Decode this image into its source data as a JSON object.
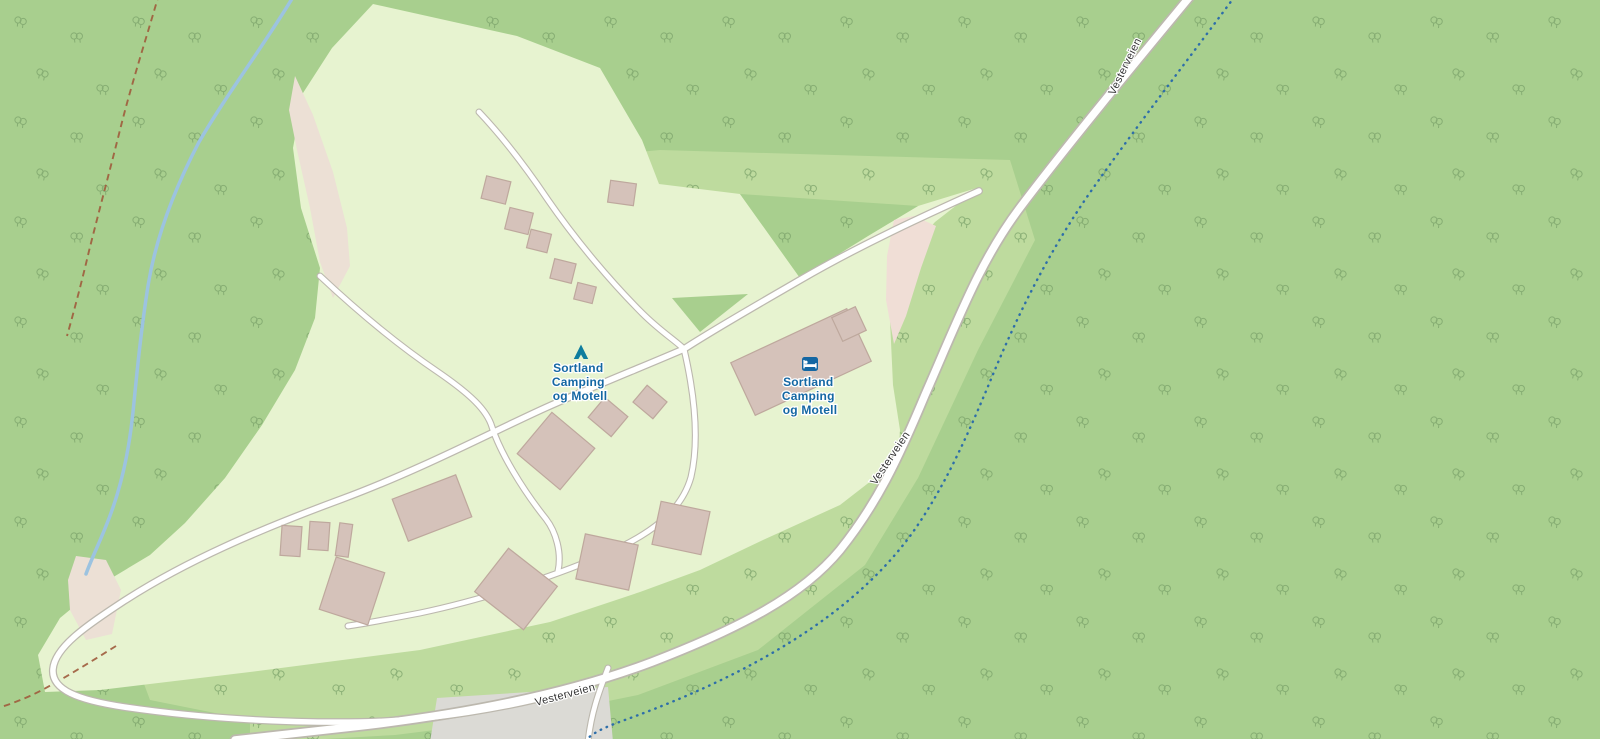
{
  "map": {
    "kind": "openstreetmap-style slippy map tile view",
    "pois": [
      {
        "id": "campsite",
        "icon": "tent-icon",
        "label_lines": [
          "Sortland",
          "Camping",
          "og Motell"
        ]
      },
      {
        "id": "motel",
        "icon": "motel-icon",
        "label_lines": [
          "Sortland",
          "Camping",
          "og Motell"
        ]
      }
    ],
    "roads": [
      {
        "name": "Vesterveien",
        "label_instances": 3
      }
    ]
  },
  "palette": {
    "forest": "#a8cf8e",
    "grass": "#bedb9e",
    "camp": "#e7f3d0",
    "tree": "#7aa269",
    "road_fill": "#ffffff",
    "road_casing": "#bcb8ae",
    "water": "#9cc3e0",
    "water_dotted": "#2e6ea9",
    "trail": "#9e5b3c",
    "bare": "#ece0d5",
    "bare_pink": "#f0ded6",
    "parking": "#dbdad5",
    "building_fill": "#d5c2ba",
    "building_stroke": "#bea89d",
    "poi_label": "#1467a3",
    "poi_icon": "#0e7d9e",
    "road_label": "#333333"
  }
}
